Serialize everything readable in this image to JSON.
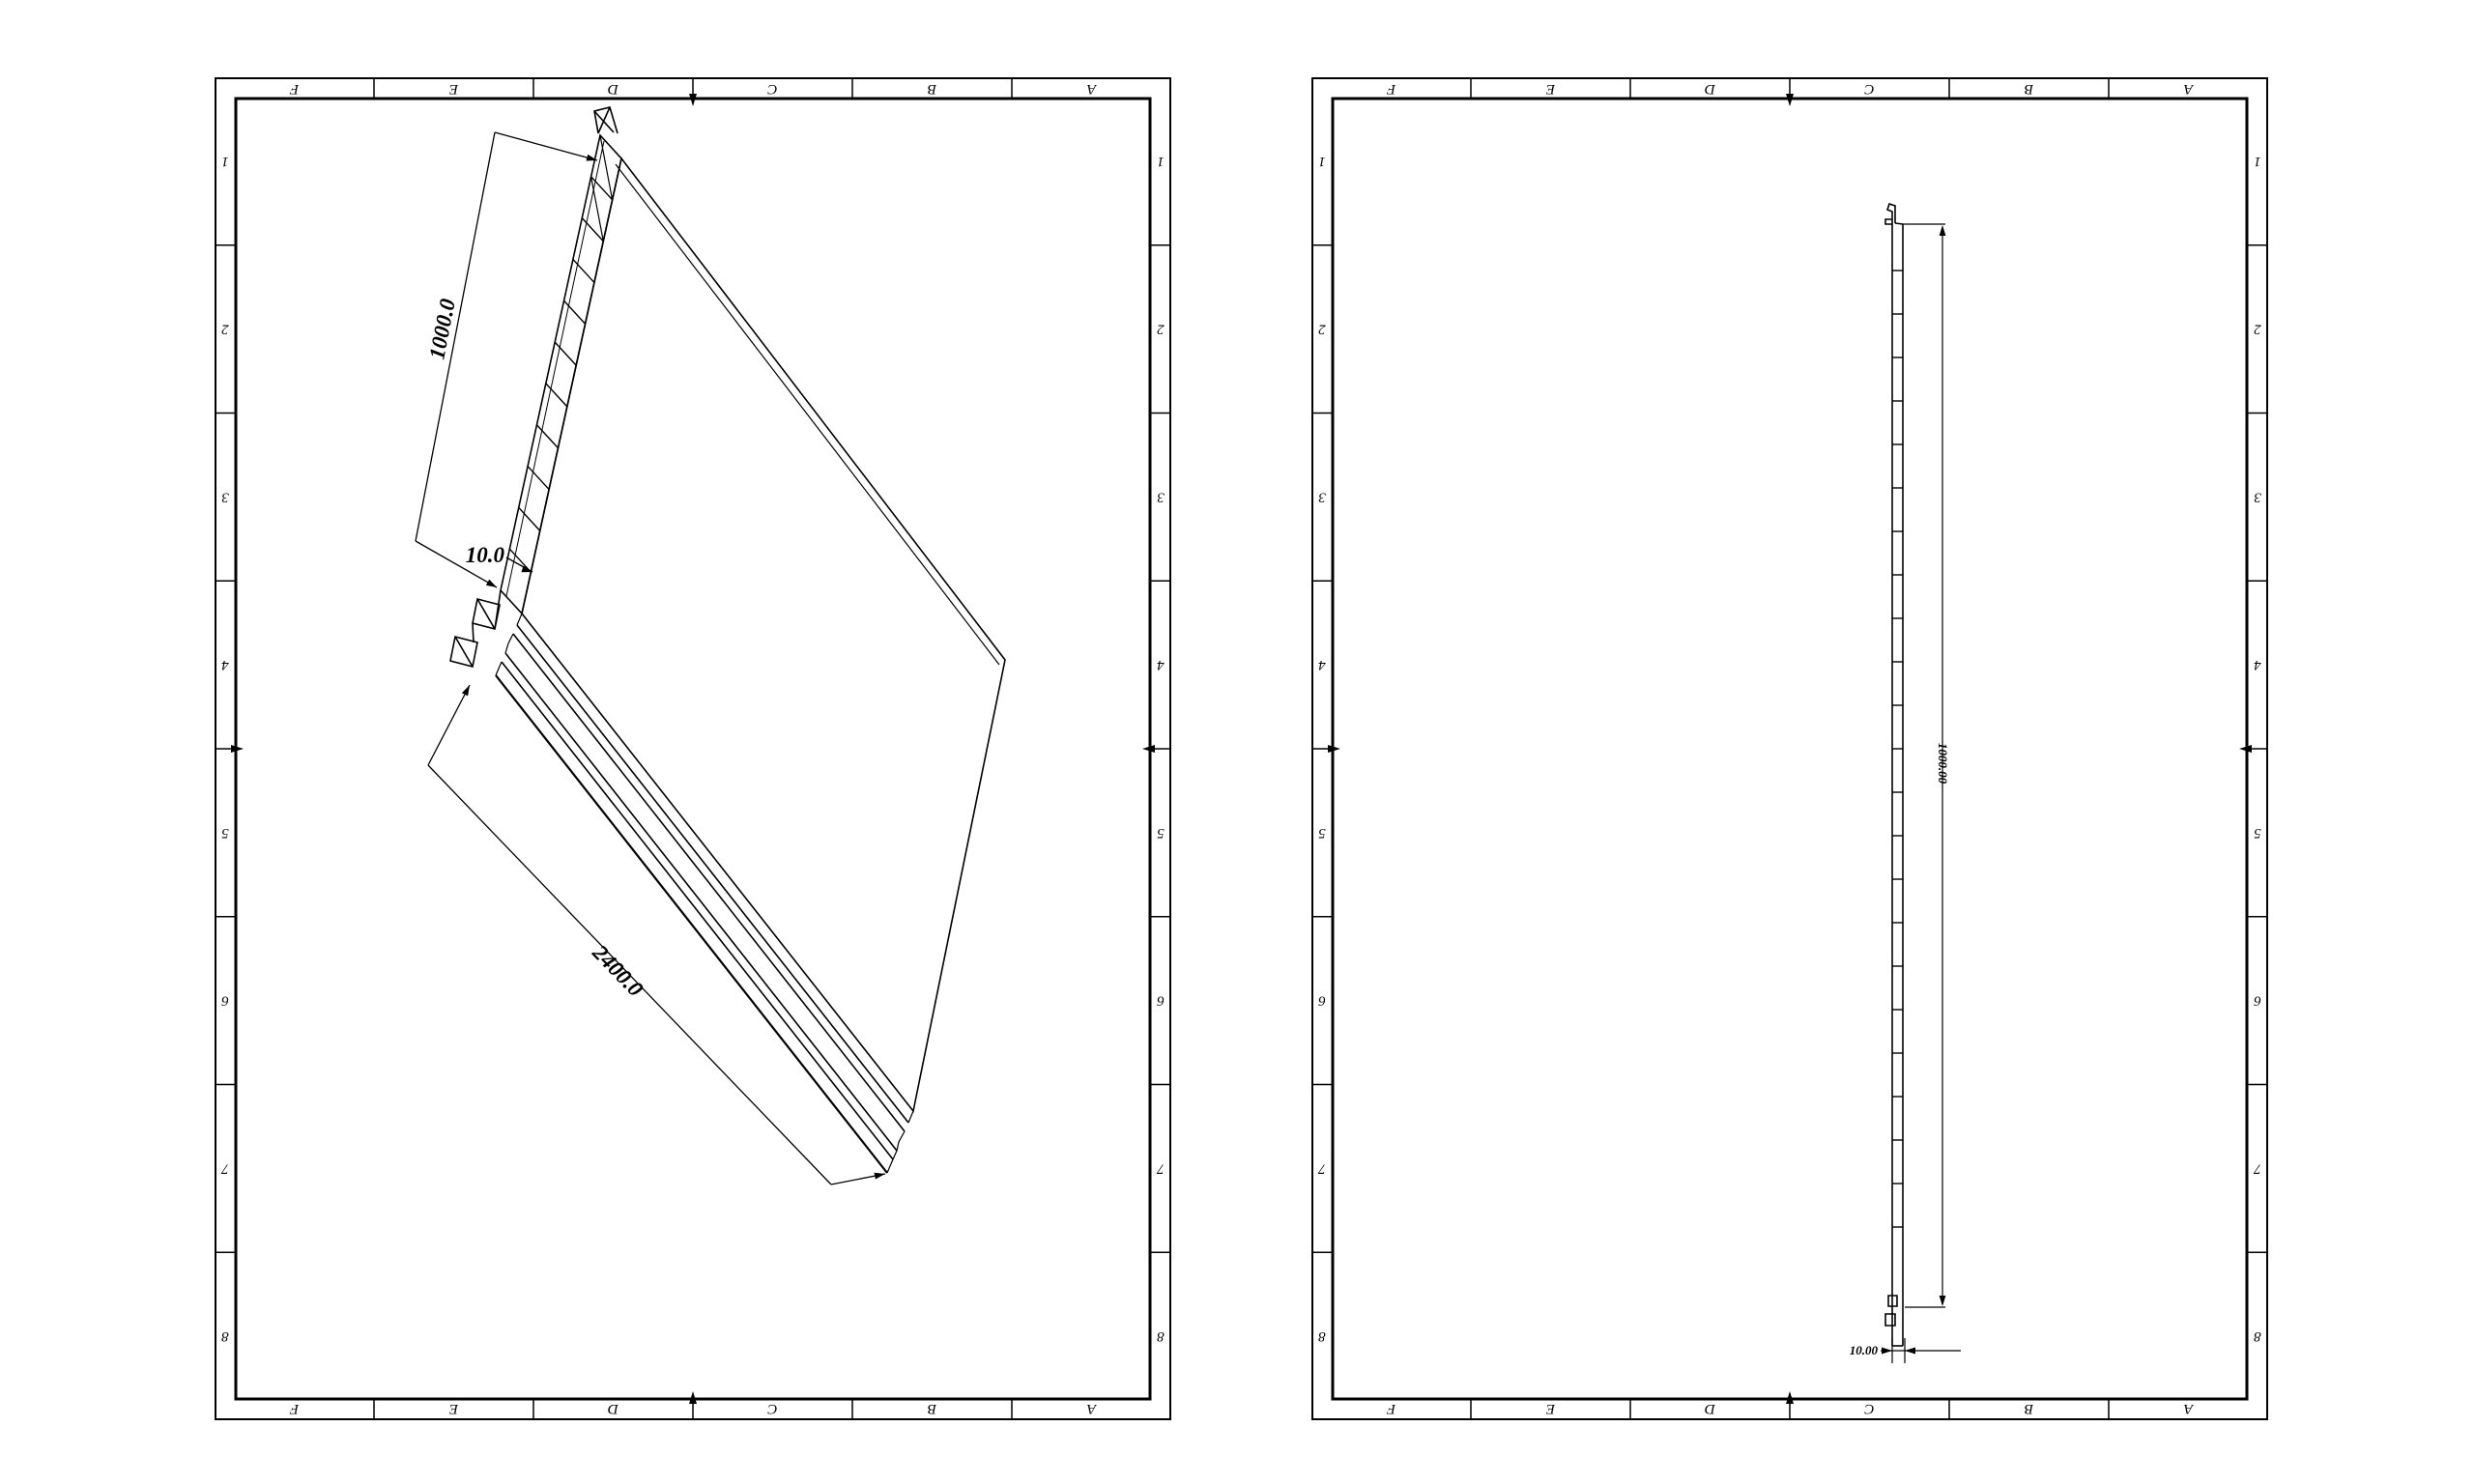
{
  "paper_color": "#ffffff",
  "ink_color": "#000000",
  "sheet_left": {
    "zones_top": [
      "F",
      "E",
      "D",
      "C",
      "B",
      "A"
    ],
    "zones_bottom": [
      "F",
      "E",
      "D",
      "C",
      "B",
      "A"
    ],
    "zones_left": [
      "1",
      "2",
      "3",
      "4",
      "5",
      "6",
      "7",
      "8"
    ],
    "zones_right": [
      "1",
      "2",
      "3",
      "4",
      "5",
      "6",
      "7",
      "8"
    ],
    "dim_width": "1000.0",
    "dim_thickness": "10.0",
    "dim_length": "2400.0"
  },
  "sheet_right": {
    "zones_top": [
      "F",
      "E",
      "D",
      "C",
      "B",
      "A"
    ],
    "zones_bottom": [
      "F",
      "E",
      "D",
      "C",
      "B",
      "A"
    ],
    "zones_left": [
      "1",
      "2",
      "3",
      "4",
      "5",
      "6",
      "7",
      "8"
    ],
    "zones_right": [
      "1",
      "2",
      "3",
      "4",
      "5",
      "6",
      "7",
      "8"
    ],
    "dim_width": "1000.00",
    "dim_thickness": "10.00"
  }
}
